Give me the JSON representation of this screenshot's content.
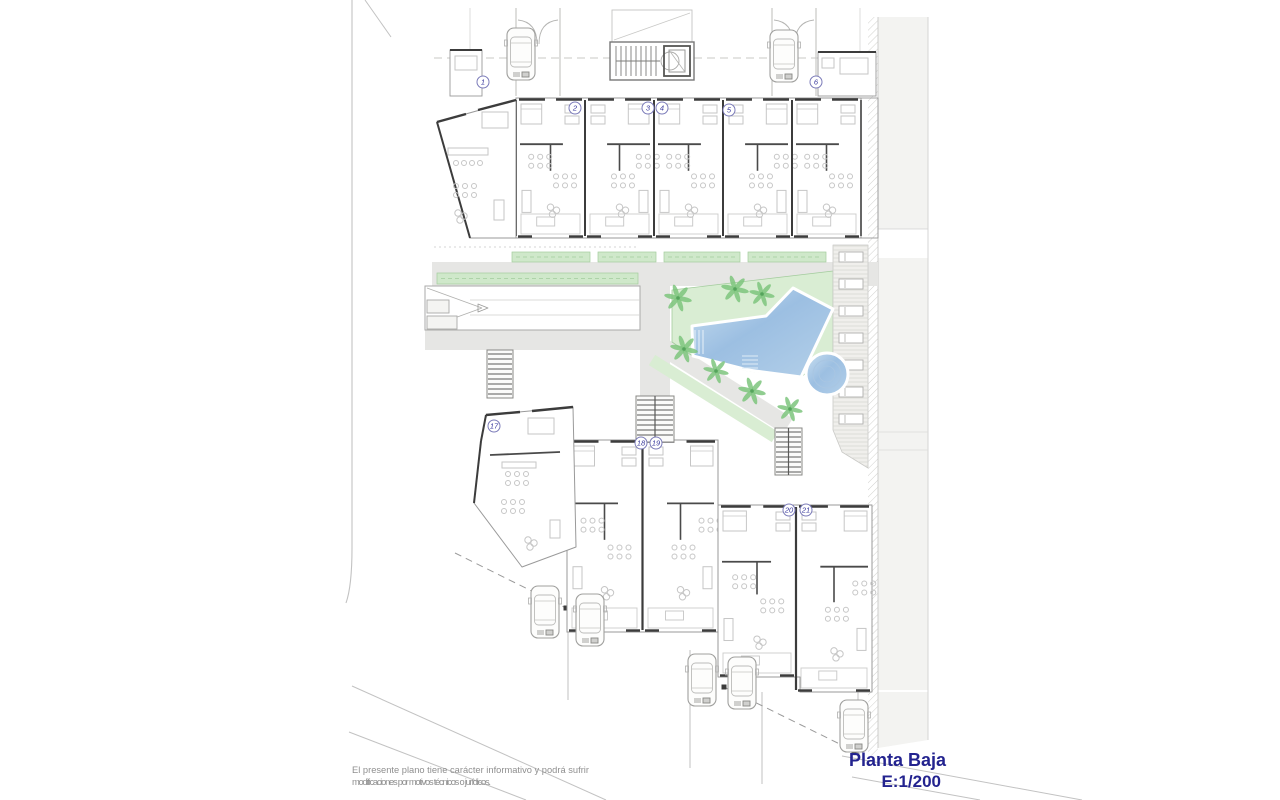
{
  "title_block": {
    "title": "Planta Baja",
    "scale": "E:1/200"
  },
  "disclaimer": {
    "line1": "El presente plano tiene carácter informativo y podrá sufrir",
    "line2": "modificaciones por motivos técnicos o jurídicos."
  },
  "units": {
    "labels": [
      "1",
      "2",
      "3",
      "4",
      "5",
      "6",
      "17",
      "18",
      "19",
      "20",
      "21"
    ]
  },
  "site_features": {
    "pool": "swimming-pool",
    "jacuzzi": "round-plunge-pool",
    "garden": "landscaped-garden-with-palms",
    "ramp": "garage-ramp",
    "deck": "sunbed-deck",
    "stairs": "access-stairs",
    "cars_visible": 7
  },
  "colors": {
    "pool_light": "#c3dbee",
    "pool_dark": "#8fb6db",
    "pool_edge": "#ffffff",
    "garden": "#d9edd3",
    "hedge": "#cfe8ca",
    "hedge_line": "#a3cc9d",
    "palm": "#7cc47c",
    "palm_dark": "#55a45c",
    "path": "#e6e6e4",
    "sidewalk": "#f3f3f1",
    "deck": "#f0efec",
    "deck_line": "#d6d5d1",
    "outline": "#9a9a9a",
    "light_line": "#c2c2c2",
    "wall": "#3c3c3c",
    "furniture": "#c6c6c6",
    "badge_ring": "#7b7bb9",
    "badge_text": "#3a3a9e",
    "title_text": "#23238f",
    "disclaimer_text": "#8f8f8f"
  }
}
